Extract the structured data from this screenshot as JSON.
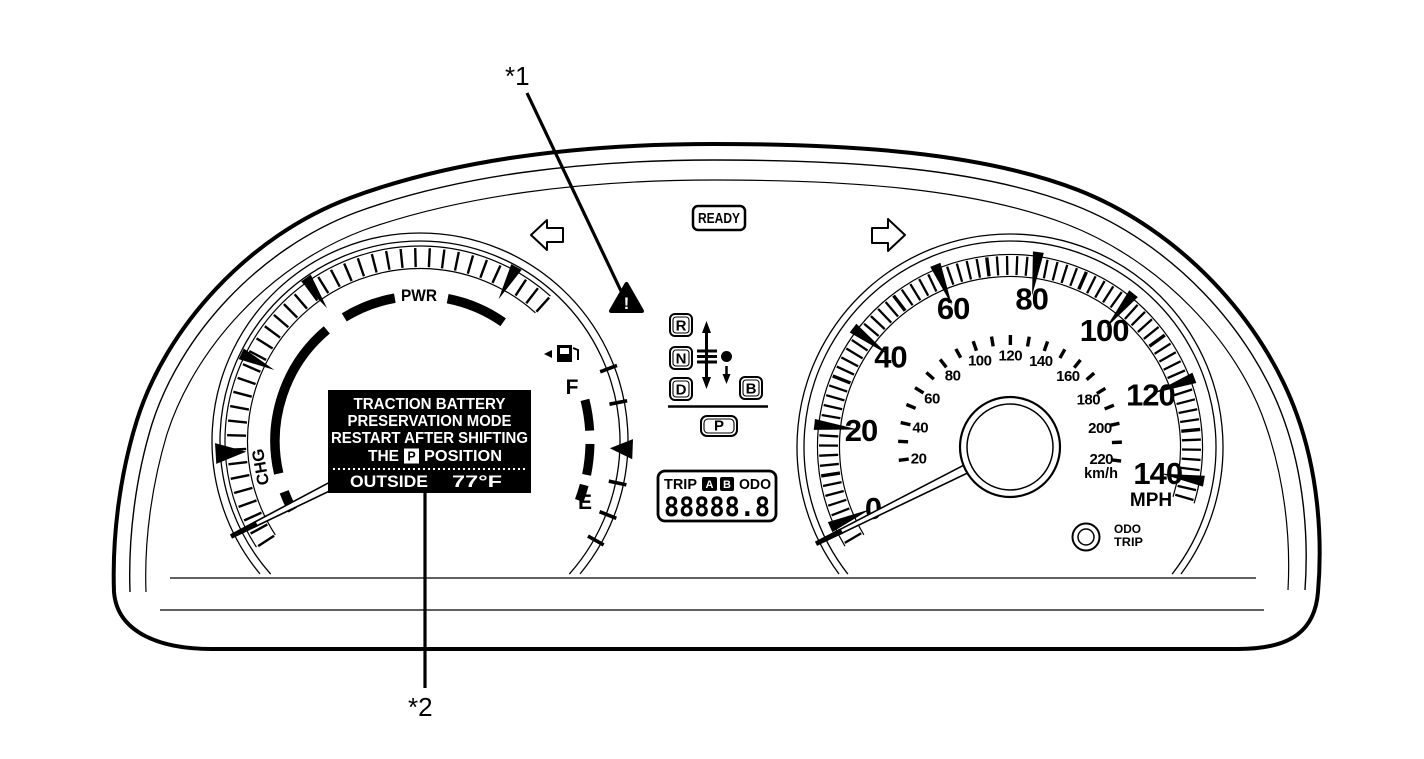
{
  "title": "hybrid-instrument-cluster-diagram",
  "colors": {
    "ink": "#000000",
    "paper": "#ffffff",
    "display_bg": "#000000",
    "display_fg": "#ffffff"
  },
  "callouts": {
    "label1": "*1",
    "label2": "*2"
  },
  "ready_indicator": {
    "label": "READY"
  },
  "warning": {
    "icon": "master-warning-triangle",
    "glyph": "!"
  },
  "turn_signals": {
    "left": "left-turn-arrow",
    "right": "right-turn-arrow"
  },
  "shift_indicator": {
    "positions": [
      "R",
      "N",
      "D"
    ],
    "b_label": "B",
    "p_label": "P"
  },
  "multi_info_display": {
    "message_lines": [
      "TRACTION BATTERY",
      "PRESERVATION MODE",
      "RESTART AFTER SHIFTING"
    ],
    "message_line4": {
      "pre": "THE",
      "boxed": "P",
      "post": "POSITION"
    },
    "outside_label": "OUTSIDE",
    "outside_temperature": "77°F"
  },
  "odometer_display": {
    "trip_label": "TRIP",
    "a_label": "A",
    "b_label": "B",
    "odo_label": "ODO",
    "digits": "88888.8"
  },
  "hybrid_system_indicator": {
    "power_label": "PWR",
    "charge_label": "CHG"
  },
  "fuel_gauge": {
    "full_label": "F",
    "empty_label": "E",
    "icon": "fuel-pump-icon"
  },
  "speedometer": {
    "unit_outer": "MPH",
    "unit_inner": "km/h",
    "mph_numbers": [
      0,
      20,
      40,
      60,
      80,
      100,
      120,
      140
    ],
    "kmh_numbers": [
      20,
      40,
      60,
      80,
      100,
      120,
      140,
      160,
      180,
      200,
      220
    ],
    "odo_trip_button_line1": "ODO",
    "odo_trip_button_line2": "TRIP",
    "needle_position_mph": 0
  }
}
